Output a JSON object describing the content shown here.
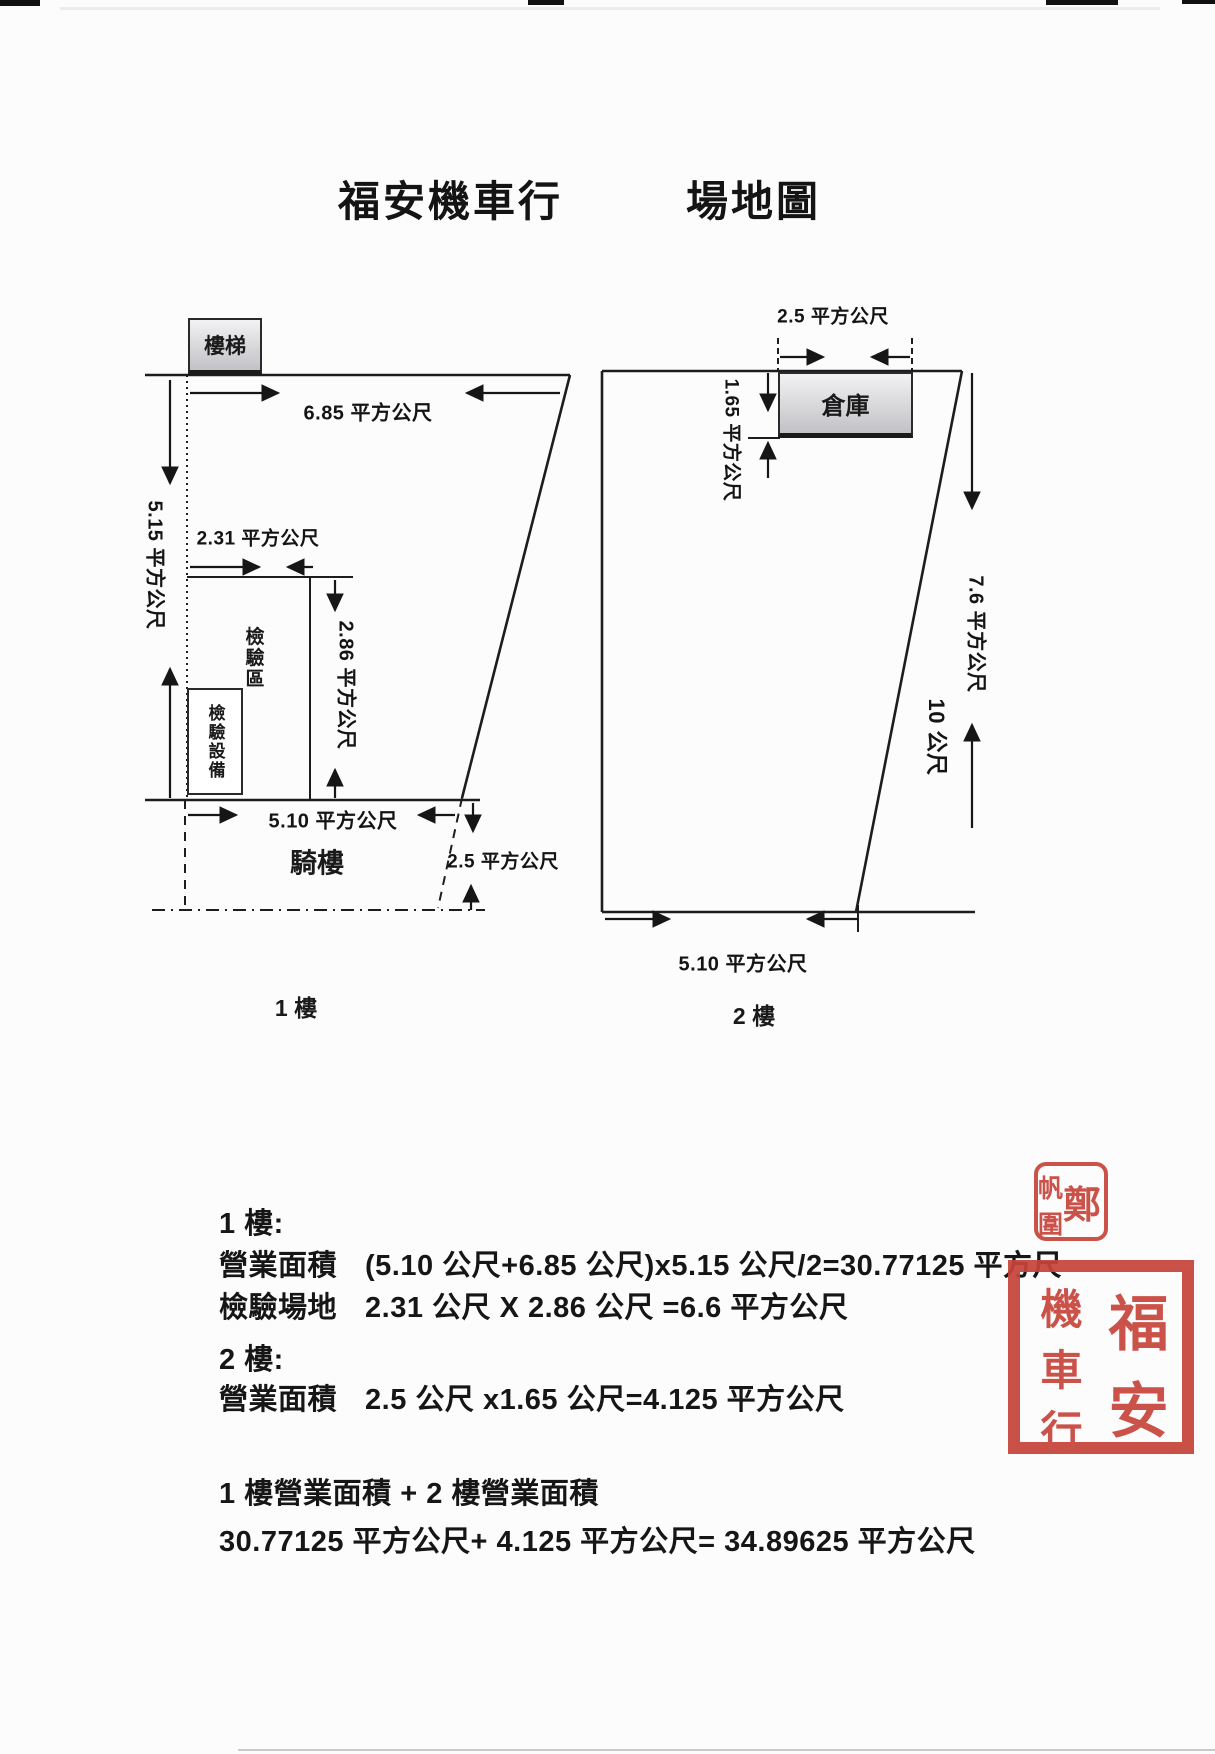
{
  "page": {
    "title_left": "福安機車行",
    "title_right": "場地圖"
  },
  "floor1": {
    "name": "1 樓",
    "stairs_label": "樓梯",
    "dim_top_width": "6.85 平方公尺",
    "dim_left_depth": "5.15 平方公尺",
    "dim_inspect_width": "2.31 平方公尺",
    "dim_inspect_depth": "2.86 平方公尺",
    "dim_bottom_width": "5.10 平方公尺",
    "dim_arcade_side": "2.5 平方公尺",
    "inspection_area": "檢驗區",
    "inspection_equipment": "檢驗設備",
    "arcade": "騎樓"
  },
  "floor2": {
    "name": "2 樓",
    "warehouse": "倉庫",
    "dim_warehouse_width": "2.5 平方公尺",
    "dim_warehouse_depth": "1.65 平方公尺",
    "dim_right_depth": "7.6 平方公尺",
    "dim_total_depth": "10 公尺",
    "dim_bottom_width": "5.10 平方公尺"
  },
  "calculations": {
    "floor1_heading": "1 樓:",
    "floor1_line1_label": "營業面積",
    "floor1_line1_value": "(5.10 公尺+6.85 公尺)x5.15 公尺/2=30.77125 平方尺",
    "floor1_line2_label": "檢驗場地",
    "floor1_line2_value": "2.31 公尺  X 2.86 公尺  =6.6 平方公尺",
    "floor2_heading": "2 樓:",
    "floor2_line1_label": "營業面積",
    "floor2_line1_value": "2.5 公尺 x1.65 公尺=4.125 平方公尺",
    "total_line1": "1 樓營業面積  + 2 樓營業面積",
    "total_line2": "30.77125 平方公尺+ 4.125 平方公尺= 34.89625 平方公尺"
  },
  "stamps": {
    "seal_color": "#c8463c",
    "name_seal": {
      "right": "鄭",
      "left_top": "帆",
      "left_bottom": "圍"
    },
    "company_seal": {
      "r1": "福",
      "r2": "安",
      "l1": "機",
      "l2": "車",
      "l3": "行"
    }
  }
}
